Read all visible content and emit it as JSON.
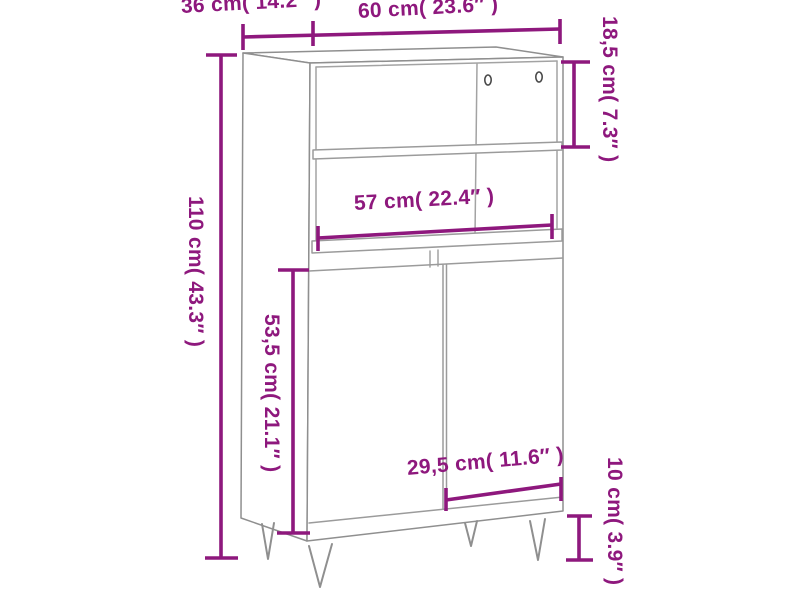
{
  "page": {
    "background_color": "#ffffff"
  },
  "diagram": {
    "kind": "product-dimension-diagram",
    "subject": "highboard cabinet with open shelf, two doors and hairpin legs",
    "accent_color": "#8E187D",
    "line_color": "#9b9b9b",
    "dimensions": [
      {
        "id": "depth",
        "label": "36 cm( 14.2″  )",
        "cm": "36",
        "inch": "14.2",
        "orientation": "horizontal"
      },
      {
        "id": "width",
        "label": "60 cm( 23.6″  )",
        "cm": "60",
        "inch": "23.6",
        "orientation": "horizontal"
      },
      {
        "id": "top_compartment_height",
        "label": "18,5 cm( 7.3″  )",
        "cm": "18,5",
        "inch": "7.3",
        "orientation": "vertical"
      },
      {
        "id": "total_height",
        "label": "110 cm( 43.3″  )",
        "cm": "110",
        "inch": "43.3",
        "orientation": "vertical"
      },
      {
        "id": "inner_width",
        "label": "57 cm( 22.4″  )",
        "cm": "57",
        "inch": "22.4",
        "orientation": "horizontal"
      },
      {
        "id": "door_height",
        "label": "53,5 cm( 21.1″  )",
        "cm": "53,5",
        "inch": "21.1",
        "orientation": "vertical"
      },
      {
        "id": "door_width",
        "label": "29,5 cm( 11.6″  )",
        "cm": "29,5",
        "inch": "11.6",
        "orientation": "horizontal"
      },
      {
        "id": "leg_height",
        "label": "10 cm( 3.9″  )",
        "cm": "10",
        "inch": "3.9",
        "orientation": "vertical"
      }
    ]
  }
}
